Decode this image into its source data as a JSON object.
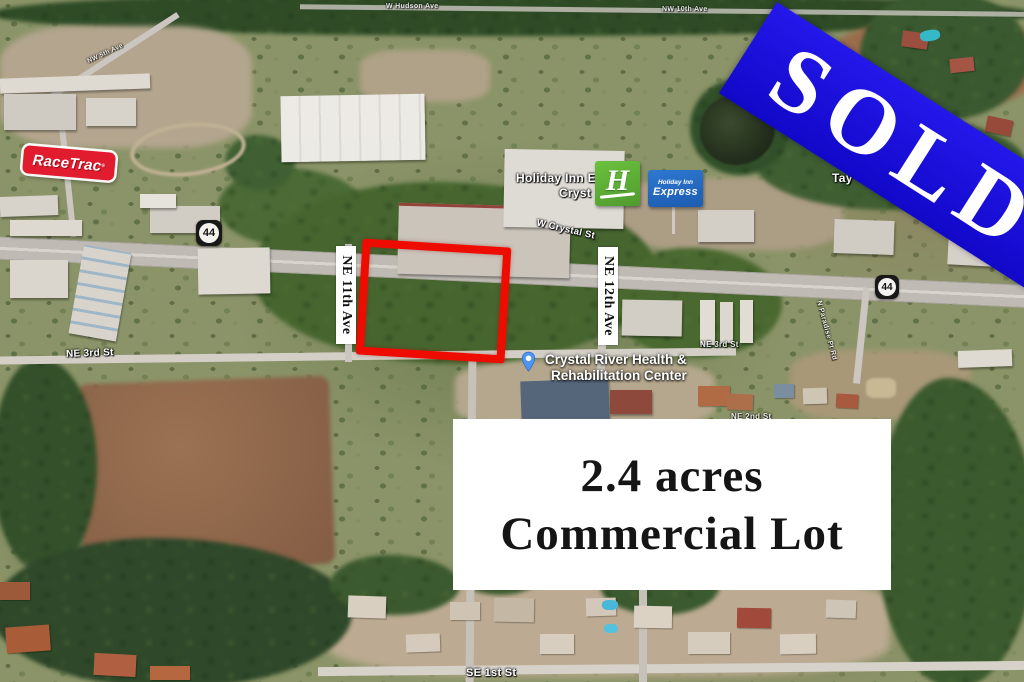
{
  "listing": {
    "sold_banner_text": "SOLD",
    "info_box": {
      "line1": "2.4 acres",
      "line2": "Commercial Lot"
    },
    "street_overlay_left": "NE 11th Ave",
    "street_overlay_right": "NE 12th Ave",
    "colors": {
      "banner_blue": "#1c12e2",
      "lot_outline_red": "#ee0b00",
      "info_box_bg": "#ffffff",
      "info_text": "#151515"
    }
  },
  "map": {
    "shields": [
      "44",
      "44"
    ],
    "brands": {
      "racetrac": {
        "name": "RaceTrac",
        "reg": "®",
        "sign_red": "#e11c2e"
      },
      "holiday_inn_map_label": {
        "line1_fragment": "Holiday Inn E",
        "line2_fragment": "Cryst"
      },
      "holiday_inn_logo": {
        "monogram": "H",
        "green": "#5cae36"
      },
      "holiday_inn_express_sign": {
        "line1": "Holiday Inn",
        "line2": "Express",
        "blue": "#1d63c4"
      },
      "rehab_center": {
        "line1": "Crystal River Health &",
        "line2": "Rehabilitation Center",
        "pin_color": "#4e95f0"
      }
    },
    "street_labels": [
      {
        "text": "NE 3rd St"
      },
      {
        "text": "W Crystal St"
      },
      {
        "text": "SE 1st St"
      },
      {
        "text": "Tay"
      },
      {
        "text": "NE 3rd St"
      },
      {
        "text": "NE 2nd St"
      },
      {
        "text": "W Hudson Ave"
      },
      {
        "text": "NW 10th Ave"
      },
      {
        "text": "NW 5th Ave"
      },
      {
        "text": "N Paradise Pt Rd"
      }
    ]
  }
}
